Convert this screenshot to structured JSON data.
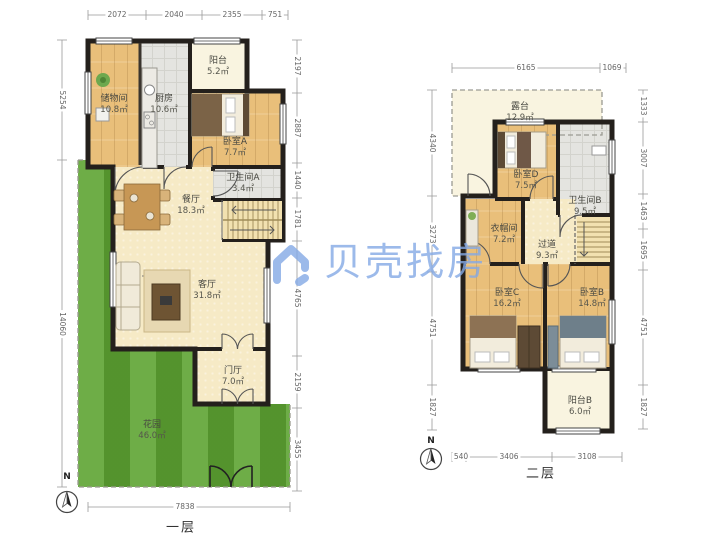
{
  "watermark": {
    "logo": "beike-house-logo",
    "text": "贝壳找房",
    "color": "#84a9e6"
  },
  "floor1": {
    "title": "一层",
    "north_label": "N",
    "rooms": {
      "balcony": {
        "name": "阳台",
        "area": "5.2㎡"
      },
      "storage": {
        "name": "储物间",
        "area": "10.8㎡"
      },
      "kitchen": {
        "name": "厨房",
        "area": "10.6㎡"
      },
      "bedroom_a": {
        "name": "卧室A",
        "area": "7.7㎡"
      },
      "bath_a": {
        "name": "卫生间A",
        "area": "3.4㎡"
      },
      "dining": {
        "name": "餐厅",
        "area": "18.3㎡"
      },
      "living": {
        "name": "客厅",
        "area": "31.8㎡"
      },
      "foyer": {
        "name": "门厅",
        "area": "7.0㎡"
      },
      "garden": {
        "name": "花园",
        "area": "46.0㎡"
      }
    },
    "dims": {
      "top": [
        "2072",
        "2040",
        "2355",
        "751"
      ],
      "left": [
        "5254",
        "14060"
      ],
      "right": [
        "2197",
        "2887",
        "1440",
        "1781",
        "4765",
        "2159",
        "3455"
      ],
      "bottom": [
        "7838"
      ]
    }
  },
  "floor2": {
    "title": "二层",
    "north_label": "N",
    "rooms": {
      "terrace": {
        "name": "露台",
        "area": "12.9㎡"
      },
      "bedroom_d": {
        "name": "卧室D",
        "area": "7.5㎡"
      },
      "bath_b": {
        "name": "卫生间B",
        "area": "9.5㎡"
      },
      "cloakroom": {
        "name": "衣帽间",
        "area": "7.2㎡"
      },
      "hallway": {
        "name": "过道",
        "area": "9.3㎡"
      },
      "bedroom_c": {
        "name": "卧室C",
        "area": "16.2㎡"
      },
      "bedroom_b": {
        "name": "卧室B",
        "area": "14.8㎡"
      },
      "balcony_b": {
        "name": "阳台B",
        "area": "6.0㎡"
      }
    },
    "dims": {
      "top": [
        "6165",
        "1069"
      ],
      "left": [
        "4340",
        "3273",
        "4751",
        "1827"
      ],
      "right": [
        "1333",
        "3007",
        "1463",
        "1695",
        "4751",
        "1827"
      ],
      "bottom": [
        "540",
        "3406",
        "3108"
      ]
    }
  }
}
